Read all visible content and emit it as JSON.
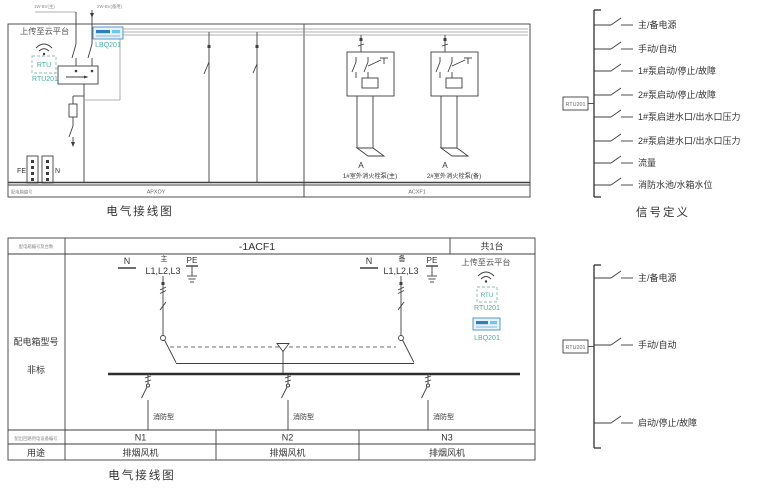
{
  "colors": {
    "line": "#3f3f3f",
    "teal": "#4aada2",
    "blue": "#2d7fc0",
    "text": "#333333"
  },
  "top_diagram": {
    "caption": "电气接线图",
    "incoming": {
      "left": "1W-BV(主)",
      "right": "2W-BV(备用)"
    },
    "cloud": {
      "title": "上传至云平台",
      "rtu_text": "RTU",
      "rtu_id": "RTU201",
      "lbq_id": "LBQ201"
    },
    "terminals": {
      "fe": "FE",
      "n": "N"
    },
    "pumps": [
      {
        "phase": "A",
        "caption": "1#室外消火栓泵(主)"
      },
      {
        "phase": "A",
        "caption": "2#室外消火栓泵(备)"
      }
    ],
    "strip": {
      "left_label": "配电箱编号",
      "code_left": "APXOY",
      "code_right": "ACXF1"
    }
  },
  "signals_top": {
    "source_id": "RTU201",
    "items": [
      "主/备电源",
      "手动/自动",
      "1#泵启动/停止/故障",
      "2#泵启动/停止/故障",
      "1#泵启进水口/出水口压力",
      "2#泵启进水口/出水口压力",
      "流量",
      "消防水池/水箱水位"
    ],
    "caption": "信号定义"
  },
  "signals_bottom": {
    "source_id": "RTU201",
    "items": [
      "主/备电源",
      "手动/自动",
      "启动/停止/故障"
    ]
  },
  "bottom_diagram": {
    "caption": "电气接线图",
    "header": {
      "left_label": "配电箱编号及台数",
      "code": "-1ACF1",
      "count": "共1台"
    },
    "rows": {
      "model_label": "配电箱型号",
      "model_value": "非标",
      "circuit_label": "配出回路用电设备编号",
      "usage_label": "用途"
    },
    "supplies": [
      {
        "n": "N",
        "role": "主",
        "phases": "L1,L2,L3",
        "pe": "PE"
      },
      {
        "n": "N",
        "role": "备",
        "phases": "L1,L2,L3",
        "pe": "PE"
      }
    ],
    "cloud": {
      "title": "上传至云平台",
      "rtu_text": "RTU",
      "rtu_id": "RTU201",
      "lbq_id": "LBQ201"
    },
    "feeders": [
      {
        "type": "消防型",
        "circuit": "N1",
        "usage": "排烟风机"
      },
      {
        "type": "消防型",
        "circuit": "N2",
        "usage": "排烟风机"
      },
      {
        "type": "消防型",
        "circuit": "N3",
        "usage": "排烟风机"
      }
    ]
  }
}
